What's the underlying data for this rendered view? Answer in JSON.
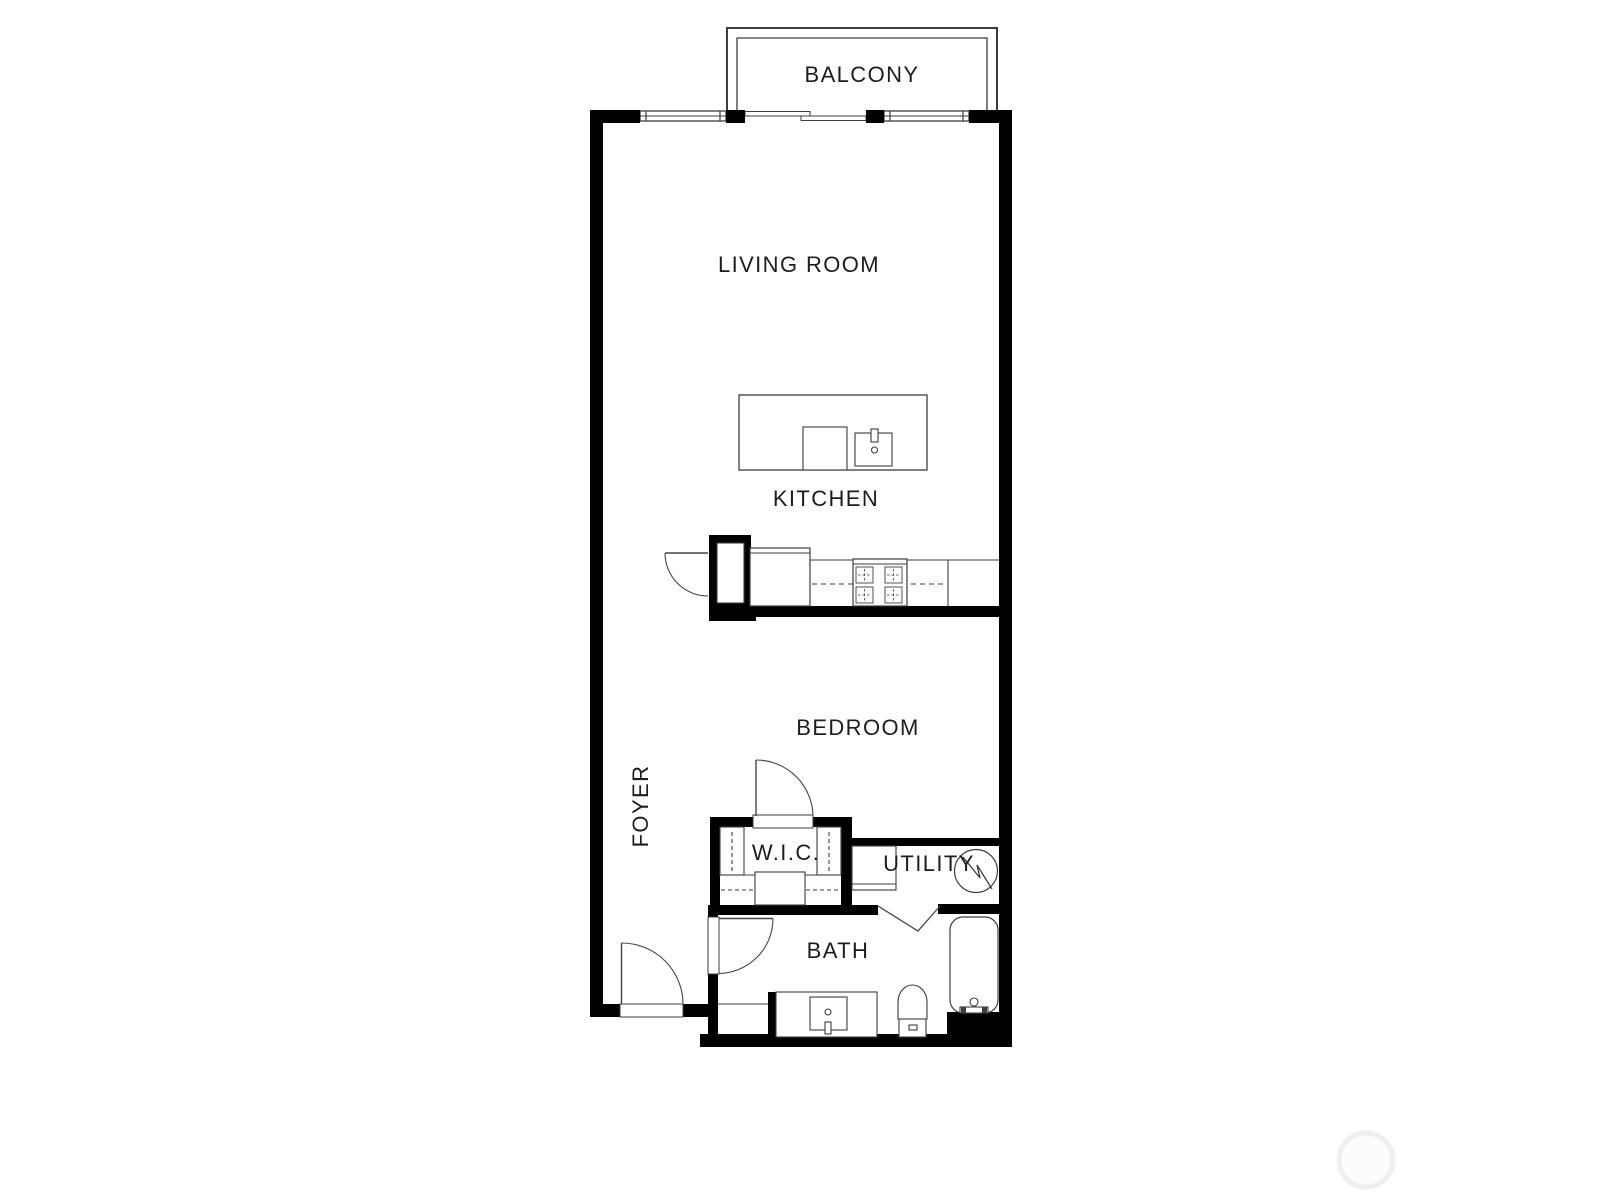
{
  "document": {
    "type": "floor-plan",
    "background": "#ffffff"
  },
  "colors": {
    "wall": "#000000",
    "line": "#3d3d3d",
    "door": "#454545",
    "text": "#1d1d1d",
    "watermark_ring": "#efefef"
  },
  "rooms": {
    "balcony": {
      "label": "BALCONY"
    },
    "living_room": {
      "label": "LIVING ROOM"
    },
    "kitchen": {
      "label": "KITCHEN"
    },
    "bedroom": {
      "label": "BEDROOM"
    },
    "foyer": {
      "label": "FOYER"
    },
    "wic": {
      "label": "W.I.C."
    },
    "utility": {
      "label": "UTILITY"
    },
    "bath": {
      "label": "BATH"
    }
  },
  "fixtures": [
    "balcony-railing",
    "sliding-glass-door",
    "window",
    "kitchen-island",
    "island-sink",
    "island-faucet",
    "dishwasher",
    "refrigerator",
    "cooktop",
    "pantry-closet",
    "closet-rod",
    "closet-shelf",
    "washer-dryer",
    "water-heater",
    "bathtub",
    "toilet",
    "vanity-sink",
    "entry-door",
    "bedroom-door",
    "bath-door",
    "kitchen-door",
    "utility-door"
  ]
}
